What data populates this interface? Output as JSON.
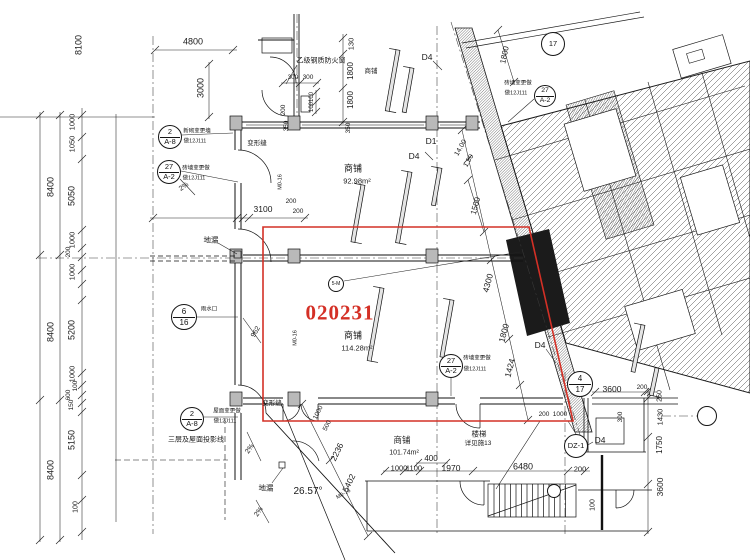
{
  "drawing": {
    "type": "architectural-floor-plan",
    "highlight": {
      "number": "020231",
      "color": "#d43026"
    },
    "rooms": [
      {
        "name": "商铺",
        "area": "92.98m²"
      },
      {
        "name": "商铺",
        "area": "114.28m²"
      },
      {
        "name": "商铺",
        "area": "101.74m²"
      }
    ],
    "angle_note": "26.57°",
    "stair_note": "楼梯 详见施13",
    "window_note": "乙级钢质防火窗",
    "line_color": "#1a1a1a"
  },
  "bubbles": [
    {
      "x": 170,
      "y": 137,
      "r": 12,
      "top": "2",
      "bottom": "A-8",
      "name": "detail-ref-2-A8"
    },
    {
      "x": 169,
      "y": 172,
      "r": 12,
      "top": "27",
      "bottom": "A-2",
      "name": "detail-ref-27-A2"
    },
    {
      "x": 184,
      "y": 317,
      "r": 13,
      "top": "6",
      "bottom": "16",
      "name": "detail-ref-6-16"
    },
    {
      "x": 192,
      "y": 419,
      "r": 12,
      "top": "2",
      "bottom": "A-8",
      "name": "detail-ref-2-A8"
    },
    {
      "x": 451,
      "y": 366,
      "r": 12,
      "top": "27",
      "bottom": "A-2",
      "name": "detail-ref-27-A2"
    },
    {
      "x": 545,
      "y": 96,
      "r": 11,
      "top": "27",
      "bottom": "A-2",
      "name": "detail-ref-27-A2"
    },
    {
      "x": 553,
      "y": 44,
      "r": 12,
      "text": "17",
      "name": "grid-bubble-17"
    },
    {
      "x": 580,
      "y": 384,
      "r": 13,
      "top": "4",
      "bottom": "17",
      "name": "grid-bubble-4-17"
    },
    {
      "x": 576,
      "y": 446,
      "r": 12,
      "text": "DZ-1",
      "name": "column-ref-DZ1"
    },
    {
      "x": 336,
      "y": 284,
      "r": 8,
      "text": "5-M",
      "name": "tag-5M"
    },
    {
      "x": 554,
      "y": 491,
      "r": 7,
      "text": "",
      "name": "stair-ref-bubble"
    },
    {
      "x": 707,
      "y": 416,
      "r": 10,
      "text": "",
      "name": "grid-bubble-right"
    }
  ],
  "labels": [
    {
      "t": "8100",
      "x": 79,
      "y": 45,
      "r": -90,
      "s": 9
    },
    {
      "t": "8400",
      "x": 51,
      "y": 187,
      "r": -90,
      "s": 9
    },
    {
      "t": "8400",
      "x": 51,
      "y": 332,
      "r": -90,
      "s": 9
    },
    {
      "t": "8400",
      "x": 51,
      "y": 470,
      "r": -90,
      "s": 9
    },
    {
      "t": "1000",
      "x": 72,
      "y": 122,
      "r": -90,
      "s": 7.5
    },
    {
      "t": "1050",
      "x": 72,
      "y": 144,
      "r": -90,
      "s": 7.5
    },
    {
      "t": "5050",
      "x": 72,
      "y": 196,
      "r": -90,
      "s": 9
    },
    {
      "t": "1000",
      "x": 72,
      "y": 240,
      "r": -90,
      "s": 7.5
    },
    {
      "t": "200",
      "x": 69,
      "y": 252,
      "r": -90,
      "s": 6.5
    },
    {
      "t": "1000",
      "x": 72,
      "y": 272,
      "r": -90,
      "s": 7.5
    },
    {
      "t": "5200",
      "x": 72,
      "y": 330,
      "r": -90,
      "s": 9
    },
    {
      "t": "1000",
      "x": 72,
      "y": 374,
      "r": -90,
      "s": 7.5
    },
    {
      "t": "100",
      "x": 76,
      "y": 386,
      "r": -90,
      "s": 6.5
    },
    {
      "t": "600",
      "x": 69,
      "y": 395,
      "r": -90,
      "s": 6.5
    },
    {
      "t": "150",
      "x": 72,
      "y": 405,
      "r": -90,
      "s": 6.5
    },
    {
      "t": "5150",
      "x": 72,
      "y": 440,
      "r": -90,
      "s": 9
    },
    {
      "t": "100",
      "x": 76,
      "y": 507,
      "r": -90,
      "s": 7
    },
    {
      "t": "4800",
      "x": 193,
      "y": 42,
      "r": 0,
      "s": 9
    },
    {
      "t": "3000",
      "x": 201,
      "y": 88,
      "r": -90,
      "s": 9
    },
    {
      "t": "130",
      "x": 351,
      "y": 44,
      "r": -90,
      "s": 7.5
    },
    {
      "t": "1800",
      "x": 351,
      "y": 71,
      "r": -90,
      "s": 8
    },
    {
      "t": "1800",
      "x": 351,
      "y": 100,
      "r": -90,
      "s": 8
    },
    {
      "t": "300",
      "x": 293,
      "y": 78,
      "r": 0,
      "s": 6.5
    },
    {
      "t": "300",
      "x": 308,
      "y": 78,
      "r": 0,
      "s": 6.5
    },
    {
      "t": "100",
      "x": 312,
      "y": 97,
      "r": -90,
      "s": 6
    },
    {
      "t": "100",
      "x": 312,
      "y": 107,
      "r": -90,
      "s": 6
    },
    {
      "t": "200",
      "x": 284,
      "y": 110,
      "r": -90,
      "s": 6.5
    },
    {
      "t": "350",
      "x": 287,
      "y": 126,
      "r": -90,
      "s": 6.5
    },
    {
      "t": "350",
      "x": 349,
      "y": 128,
      "r": -90,
      "s": 6.5
    },
    {
      "t": "1800",
      "x": 505,
      "y": 55,
      "r": -78,
      "s": 8
    },
    {
      "t": "1500",
      "x": 476,
      "y": 206,
      "r": -75,
      "s": 8
    },
    {
      "t": "3100",
      "x": 263,
      "y": 209,
      "r": 0,
      "s": 8.5
    },
    {
      "t": "200",
      "x": 291,
      "y": 202,
      "r": 0,
      "s": 6.5
    },
    {
      "t": "200",
      "x": 298,
      "y": 212,
      "r": 0,
      "s": 6.5
    },
    {
      "t": "962",
      "x": 256,
      "y": 332,
      "r": -60,
      "s": 7
    },
    {
      "t": "4300",
      "x": 488,
      "y": 283,
      "r": -75,
      "s": 8.5
    },
    {
      "t": "1800",
      "x": 504,
      "y": 333,
      "r": -75,
      "s": 8.5
    },
    {
      "t": "1424",
      "x": 510,
      "y": 368,
      "r": -75,
      "s": 8.5
    },
    {
      "t": "14.00",
      "x": 461,
      "y": 148,
      "r": -60,
      "s": 7
    },
    {
      "t": "1.50",
      "x": 469,
      "y": 161,
      "r": -60,
      "s": 7
    },
    {
      "t": "400",
      "x": 431,
      "y": 459,
      "r": 0,
      "s": 8
    },
    {
      "t": "1000",
      "x": 399,
      "y": 468,
      "r": 0,
      "s": 7.5
    },
    {
      "t": "1100",
      "x": 414,
      "y": 468,
      "r": 0,
      "s": 7.5
    },
    {
      "t": "1970",
      "x": 451,
      "y": 468,
      "r": 0,
      "s": 8.5
    },
    {
      "t": "6480",
      "x": 523,
      "y": 467,
      "r": 0,
      "s": 9
    },
    {
      "t": "200",
      "x": 580,
      "y": 469,
      "r": 0,
      "s": 7.5
    },
    {
      "t": "100",
      "x": 593,
      "y": 505,
      "r": -90,
      "s": 7
    },
    {
      "t": "2236",
      "x": 337,
      "y": 452,
      "r": -64,
      "s": 8.5
    },
    {
      "t": "5402",
      "x": 349,
      "y": 483,
      "r": -64,
      "s": 8.5
    },
    {
      "t": "1000",
      "x": 319,
      "y": 413,
      "r": -64,
      "s": 6.5
    },
    {
      "t": "500",
      "x": 328,
      "y": 426,
      "r": -64,
      "s": 6.5
    },
    {
      "t": "26.57°",
      "x": 308,
      "y": 492,
      "r": 0,
      "s": 10,
      "n": "angle-dimension"
    },
    {
      "t": "200",
      "x": 544,
      "y": 415,
      "r": 0,
      "s": 6.5
    },
    {
      "t": "1000",
      "x": 560,
      "y": 415,
      "r": 0,
      "s": 6.5
    },
    {
      "t": "3600",
      "x": 612,
      "y": 389,
      "r": 0,
      "s": 8.5
    },
    {
      "t": "200",
      "x": 642,
      "y": 388,
      "r": 0,
      "s": 6.5
    },
    {
      "t": "300",
      "x": 621,
      "y": 417,
      "r": -90,
      "s": 6.5
    },
    {
      "t": "250",
      "x": 660,
      "y": 396,
      "r": -90,
      "s": 7
    },
    {
      "t": "1430",
      "x": 660,
      "y": 417,
      "r": -90,
      "s": 7.5
    },
    {
      "t": "1750",
      "x": 660,
      "y": 445,
      "r": -90,
      "s": 8
    },
    {
      "t": "3600",
      "x": 660,
      "y": 487,
      "r": -90,
      "s": 8.5
    },
    {
      "t": "商铺",
      "x": 353,
      "y": 169,
      "r": 0,
      "s": 9,
      "n": "room-label-shop-upper"
    },
    {
      "t": "92.98m²",
      "x": 357,
      "y": 181,
      "r": 0,
      "s": 7.5,
      "n": "room-area-upper"
    },
    {
      "t": "商铺",
      "x": 353,
      "y": 336,
      "r": 0,
      "s": 9,
      "n": "room-label-shop-highlight"
    },
    {
      "t": "114.28m²",
      "x": 357,
      "y": 348,
      "r": 0,
      "s": 7.5,
      "n": "room-area-highlight"
    },
    {
      "t": "商铺",
      "x": 402,
      "y": 440,
      "r": 0,
      "s": 8.5,
      "n": "room-label-shop-lower"
    },
    {
      "t": "101.74m²",
      "x": 404,
      "y": 453,
      "r": 0,
      "s": 7,
      "n": "room-area-lower"
    },
    {
      "t": "楼梯",
      "x": 479,
      "y": 434,
      "r": 0,
      "s": 7.5,
      "n": "stair-label"
    },
    {
      "t": "详见施13",
      "x": 478,
      "y": 444,
      "r": 0,
      "s": 6.5,
      "n": "stair-note"
    },
    {
      "t": "乙级钢质防火窗",
      "x": 321,
      "y": 61,
      "r": 0,
      "s": 7,
      "n": "fire-window-note"
    },
    {
      "t": "商铺",
      "x": 371,
      "y": 72,
      "r": 0,
      "s": 6.5
    },
    {
      "t": "变形缝",
      "x": 257,
      "y": 144,
      "r": 0,
      "s": 6.5,
      "n": "expansion-joint-label"
    },
    {
      "t": "变形缝",
      "x": 272,
      "y": 404,
      "r": 0,
      "s": 6.5,
      "n": "expansion-joint-label"
    },
    {
      "t": "地漏",
      "x": 211,
      "y": 240,
      "r": 0,
      "s": 7.5,
      "n": "floor-drain-label"
    },
    {
      "t": "地漏",
      "x": 266,
      "y": 488,
      "r": 0,
      "s": 7.5,
      "n": "floor-drain-label"
    },
    {
      "t": "三层及屋面投影线",
      "x": 196,
      "y": 440,
      "r": 0,
      "s": 7,
      "n": "projection-line-note"
    },
    {
      "t": "020231",
      "x": 340,
      "y": 313,
      "r": 0,
      "s": 21,
      "c": "#d43026",
      "f": "serif",
      "n": "highlight-room-number"
    },
    {
      "t": "D4",
      "x": 427,
      "y": 57,
      "r": 0,
      "s": 8.5,
      "n": "door-tag-D4"
    },
    {
      "t": "D1",
      "x": 431,
      "y": 141,
      "r": 0,
      "s": 8.5,
      "n": "door-tag-D1"
    },
    {
      "t": "D4",
      "x": 414,
      "y": 156,
      "r": 0,
      "s": 8.5,
      "n": "door-tag-D4"
    },
    {
      "t": "D4",
      "x": 540,
      "y": 345,
      "r": 0,
      "s": 8.5,
      "n": "door-tag-D4"
    },
    {
      "t": "D4",
      "x": 600,
      "y": 440,
      "r": 0,
      "s": 8.5,
      "n": "door-tag-D4"
    },
    {
      "t": "M0-16",
      "x": 281,
      "y": 182,
      "r": -90,
      "s": 5.5,
      "n": "door-tag-M016"
    },
    {
      "t": "M0-16",
      "x": 296,
      "y": 338,
      "r": -90,
      "s": 5.5,
      "n": "door-tag-M016"
    },
    {
      "t": "M0-16",
      "x": 344,
      "y": 495,
      "r": -30,
      "s": 5.5,
      "n": "door-tag-M016"
    },
    {
      "t": "2%",
      "x": 250,
      "y": 449,
      "r": -55,
      "s": 7,
      "n": "slope-label"
    },
    {
      "t": "2%",
      "x": 259,
      "y": 512,
      "r": -55,
      "s": 7,
      "n": "slope-label"
    },
    {
      "t": "2%",
      "x": 184,
      "y": 187,
      "r": -35,
      "s": 7,
      "n": "slope-label"
    },
    {
      "t": "新砌变更墙",
      "x": 197,
      "y": 132,
      "r": 0,
      "s": 5.5,
      "n": "bubble-note"
    },
    {
      "t": "做12J111",
      "x": 195,
      "y": 142,
      "r": 0,
      "s": 5.5,
      "n": "bubble-note"
    },
    {
      "t": "砖墙变更做",
      "x": 196,
      "y": 169,
      "r": 0,
      "s": 5.5,
      "n": "bubble-note"
    },
    {
      "t": "做12J111",
      "x": 194,
      "y": 179,
      "r": 0,
      "s": 5.5,
      "n": "bubble-note"
    },
    {
      "t": "雨水口",
      "x": 209,
      "y": 310,
      "r": 0,
      "s": 5.5,
      "n": "bubble-note"
    },
    {
      "t": "屋面变更做",
      "x": 227,
      "y": 412,
      "r": 0,
      "s": 5.5,
      "n": "bubble-note"
    },
    {
      "t": "做12J111",
      "x": 225,
      "y": 422,
      "r": 0,
      "s": 5.5,
      "n": "bubble-note"
    },
    {
      "t": "砖墙变更做",
      "x": 477,
      "y": 359,
      "r": 0,
      "s": 5.5,
      "n": "bubble-note"
    },
    {
      "t": "做12J111",
      "x": 475,
      "y": 370,
      "r": 0,
      "s": 5.5,
      "n": "bubble-note"
    },
    {
      "t": "砖墙变更做",
      "x": 518,
      "y": 84,
      "r": 0,
      "s": 5.5,
      "n": "bubble-note"
    },
    {
      "t": "做12J111",
      "x": 516,
      "y": 94,
      "r": 0,
      "s": 5.5,
      "n": "bubble-note"
    }
  ]
}
